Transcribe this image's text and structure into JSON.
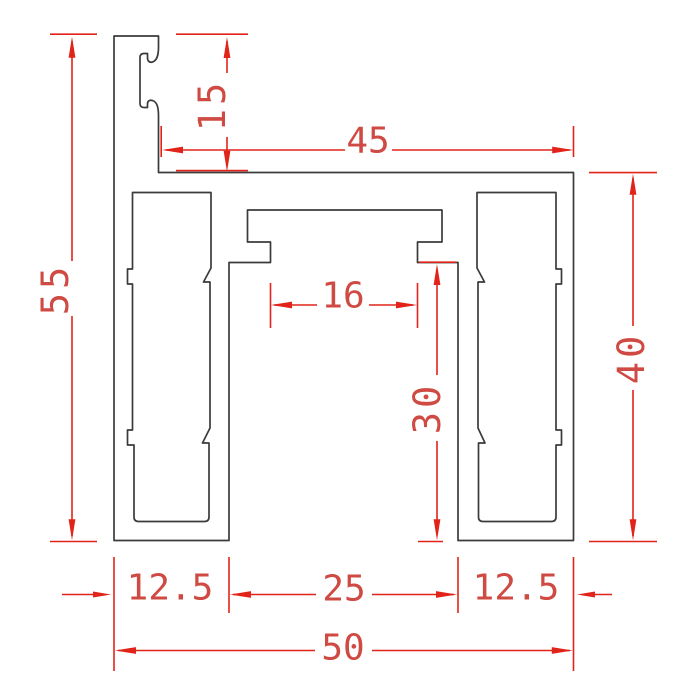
{
  "drawing": {
    "title": "aluminium-profile-cross-section",
    "units": "mm",
    "dimensions": {
      "total_height": "55",
      "top_hook_height": "15",
      "top_width": "45",
      "right_height": "40",
      "slot_opening_width": "16",
      "channel_inner_height": "30",
      "bottom_left_width": "12.5",
      "bottom_center_width": "25",
      "bottom_right_width": "12.5",
      "total_width": "50"
    },
    "colors": {
      "outline": "#3b3b3b",
      "dimension_lines": "#e2231a",
      "dimension_text": "#cf4a42",
      "background": "#ffffff"
    }
  }
}
